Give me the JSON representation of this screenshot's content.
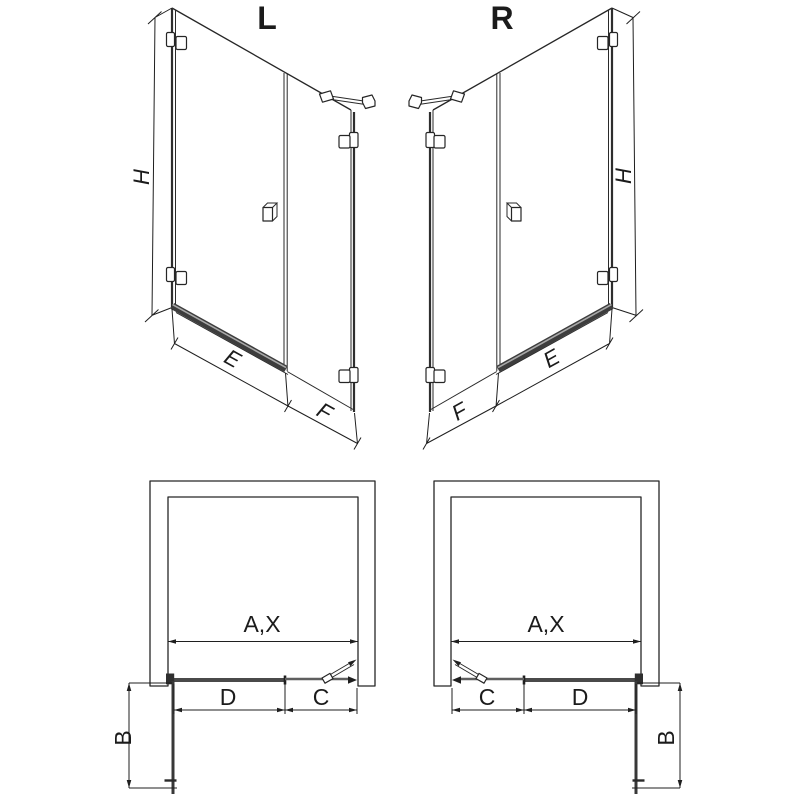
{
  "drawing": {
    "persp_left": {
      "label": "L",
      "dim_height": "H",
      "dim_door": "E",
      "dim_panel": "F"
    },
    "persp_right": {
      "label": "R",
      "dim_height": "H",
      "dim_door": "E",
      "dim_panel": "F"
    },
    "plan_left": {
      "dim_opening": "A,X",
      "dim_door": "D",
      "dim_fixed": "C",
      "dim_side": "B"
    },
    "plan_right": {
      "dim_opening": "A,X",
      "dim_door": "D",
      "dim_fixed": "C",
      "dim_side": "B"
    },
    "colors": {
      "line": "#262626",
      "glass": "#4a4a4a",
      "sill": "#3d3d3d",
      "hatch": "#404040",
      "background": "#ffffff"
    }
  }
}
